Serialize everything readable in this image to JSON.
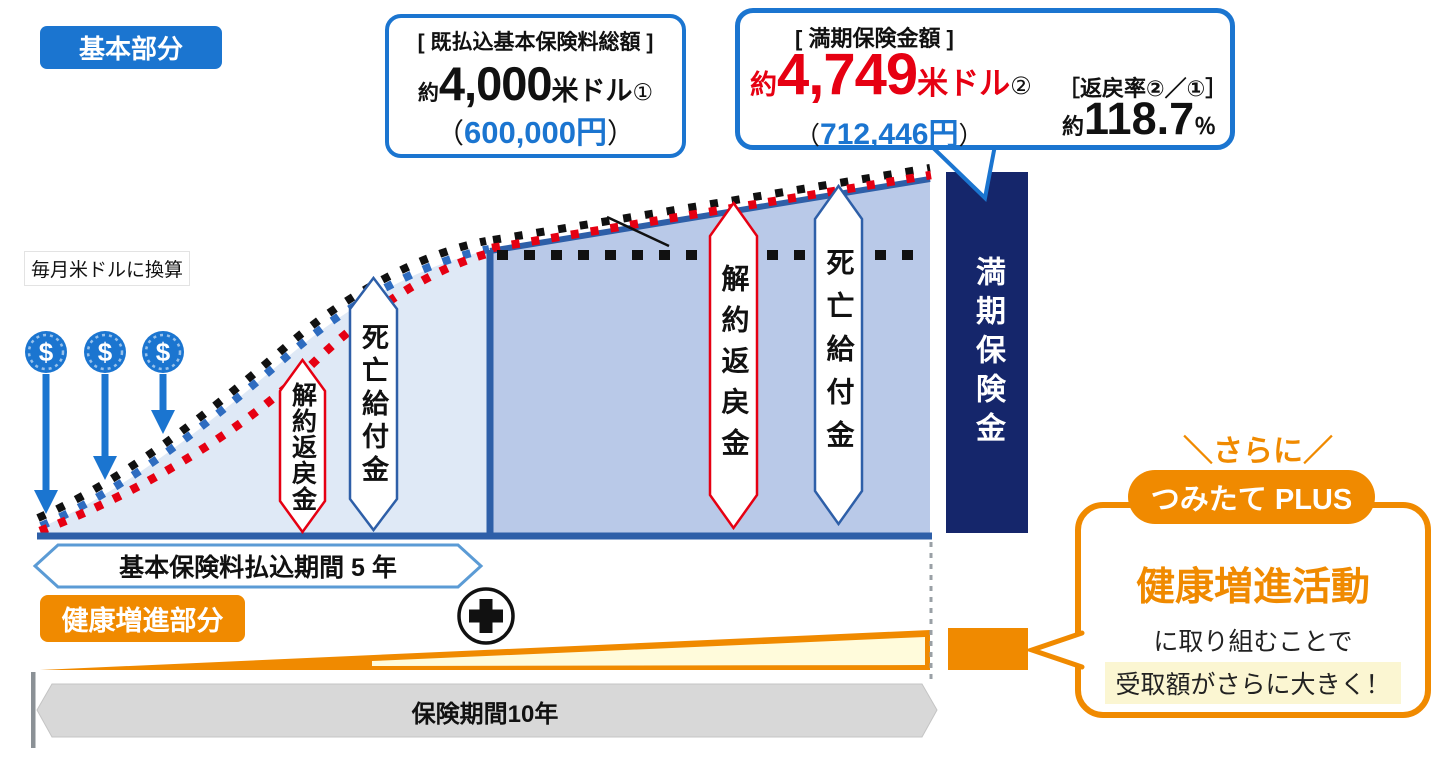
{
  "colors": {
    "blue": "#1b75d0",
    "navy": "#15266b",
    "red": "#e60012",
    "orange": "#f08a00",
    "light_area": "#dfe9f6",
    "mid_area": "#b9c9e8",
    "cream": "#fffbdb",
    "highlight": "#fbf6d2",
    "gray_bar": "#d8d8d8"
  },
  "basic_badge": "基本部分",
  "note": "毎月米ドルに換算",
  "icons": {
    "dollar": "$"
  },
  "paid_callout": {
    "title": "[ 既払込基本保険料総額 ]",
    "approx": "約",
    "amount": "4,000",
    "unit": "米ドル",
    "mark": "①",
    "paren_open": "（",
    "yen": "600,000円",
    "paren_close": "）"
  },
  "maturity_callout": {
    "title": "[ 満期保険金額 ]",
    "approx": "約",
    "amount": "4,749",
    "unit": "米ドル",
    "mark": "②",
    "paren_open": "（",
    "yen": "712,446円",
    "paren_close": "）",
    "rate_label": "［返戻率②／①］",
    "rate_approx": "約",
    "rate_value": "118.7",
    "rate_unit": "％"
  },
  "bubbles": {
    "surrender": "解約返戻金",
    "death": "死亡給付金"
  },
  "maturity_bar": "満期保険金",
  "payment_period": "基本保険料払込期間 5 年",
  "health_badge": "健康増進部分",
  "term_bar": "保険期間10年",
  "plus_note": {
    "sarani": "＼さらに／",
    "pill": "つみたて PLUS",
    "headline": "健康増進活動",
    "line2": "に取り組むことで",
    "line3": "受取額がさらに大きく！"
  }
}
